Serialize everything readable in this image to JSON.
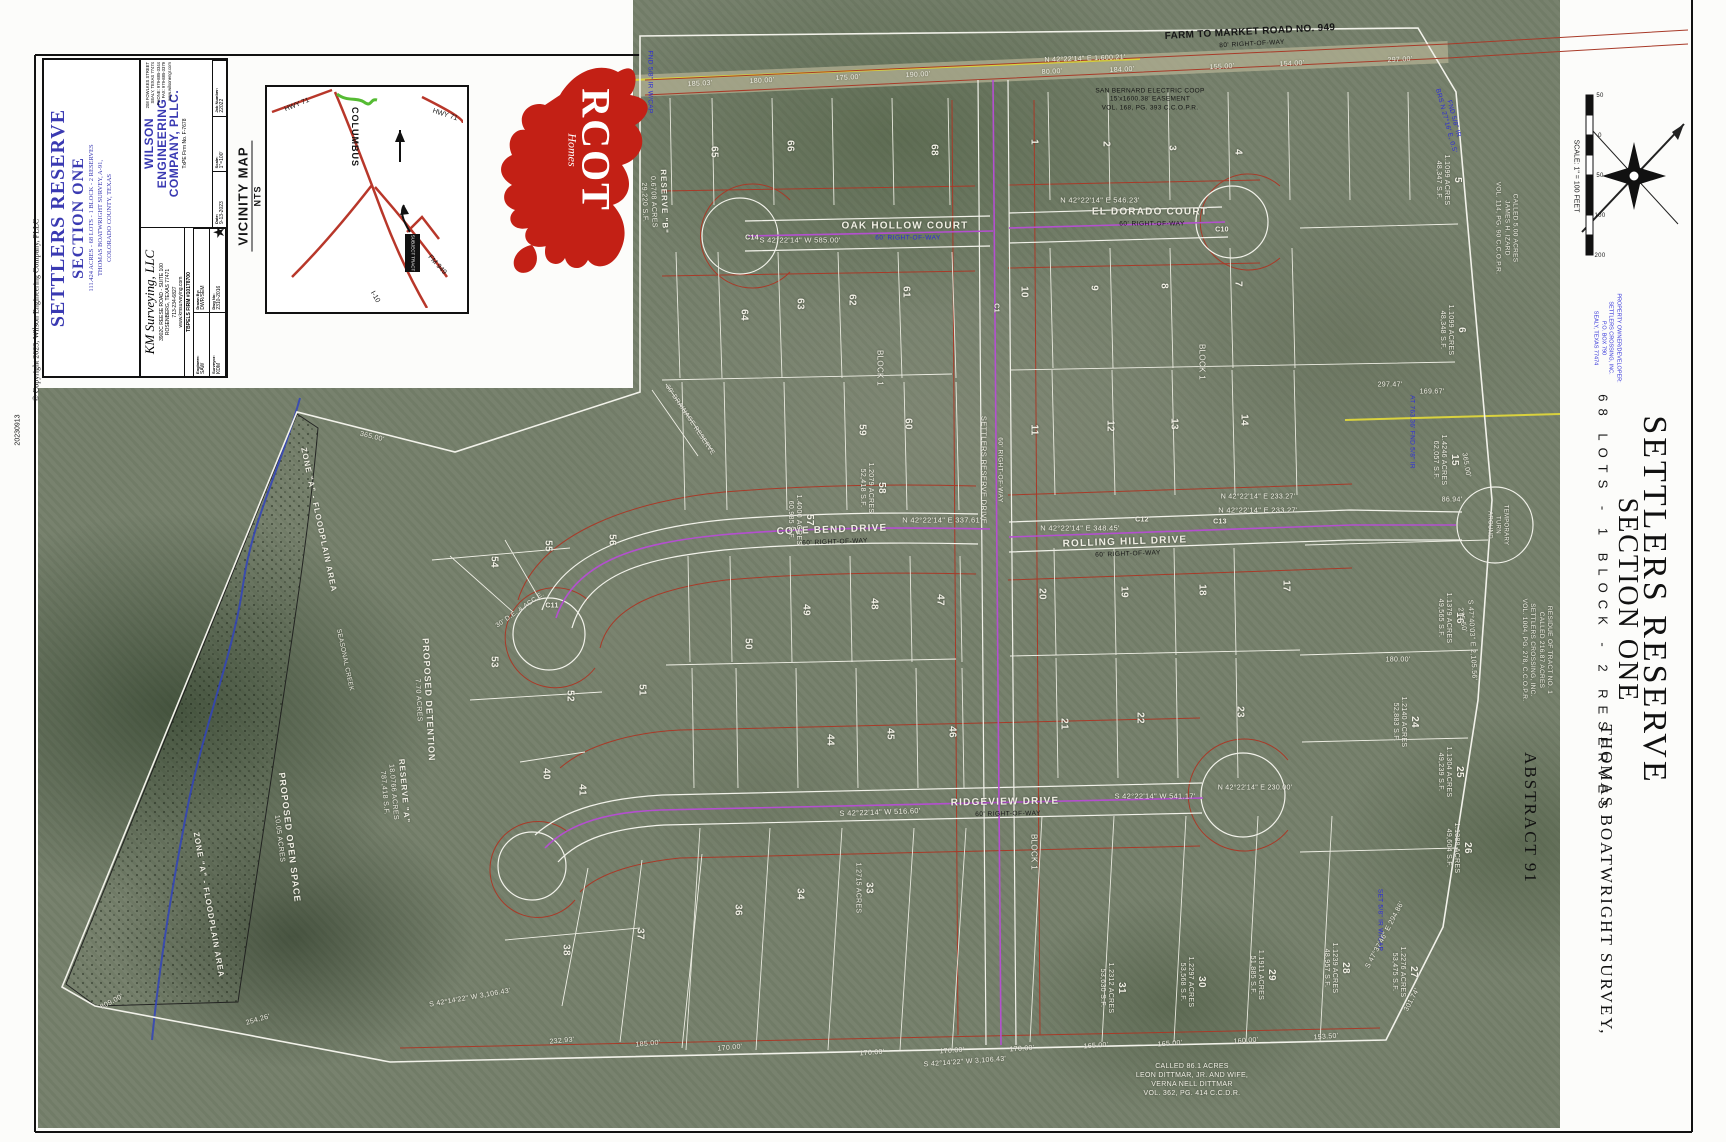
{
  "page": {
    "copyright": "© Copyright 2023, Wilson Engineering Company, PLLC",
    "stamp": "20230913"
  },
  "title_block": {
    "surveyor": {
      "name": "KM Surveying, LLC",
      "addr1": "3902C REESE ROAD - SUITE 100",
      "addr2": "ROSENBERG, TEXAS 77471",
      "phone": "713-234-6827",
      "web": "www.kmsurveying.com",
      "firm": "TBPELS FIRM #10178700"
    },
    "fields": {
      "f1l": "Engineer:",
      "f1v": "SAW",
      "f2l": "Drawn By:",
      "f2v": "DWR/SEM",
      "f3l": "Surveyor:",
      "f3v": "KDM",
      "f4l": "Dwg No:",
      "f4v": "2310-2016"
    },
    "title": {
      "line1": "SETTLERS RESERVE",
      "line2": "SECTION ONE",
      "sub1": "111.424 ACRES - 68 LOTS - 1 BLOCK - 2 RESERVES",
      "sub2": "THOMAS BOATWRIGHT SURVEY, A-91,",
      "sub3": "COLORADO COUNTY, TEXAS"
    },
    "engineer": {
      "name1": "WILSON",
      "name2": "ENGINEERING",
      "name3": "COMPANY, PLLC.",
      "firm": "TxPE Firm No. F-7678",
      "addr1": "208 FOWLKES STREET",
      "addr2": "SEALY, TEXAS 77474",
      "phone": "PHONE: 979-885-3344",
      "fax": "FAX: 979-885-3379",
      "web": "www.wilsonengr.com",
      "d1l": "Date:",
      "d1v": "9-13-2023",
      "d2l": "Scale:",
      "d2v": "1\"=100'",
      "d3l": "Job Number:",
      "d3v": "22022"
    }
  },
  "vicinity": {
    "label": "VICINITY MAP",
    "scale": "NTS",
    "town": "COLUMBUS",
    "hwy71a": "HWY 71",
    "hwy71b": "HWY 71",
    "fm949": "FM 949",
    "i10": "I-10",
    "site": "SUBJECT TRACT"
  },
  "logo": {
    "brand": "RCOT",
    "sub": "Homes"
  },
  "margin": {
    "title1": "SETTLERS RESERVE",
    "title2": "SECTION ONE",
    "subtitle": "68 LOTS - 1 BLOCK - 2 RESERVES",
    "survey": "THOMAS BOATWRIGHT SURVEY,",
    "abstract": "ABSTRACT 91",
    "scale_label": "SCALE: 1\" = 100 FEET",
    "owner": [
      "PROPERTY OWNER/DEVELOPER:",
      "SETTLERS CROSSING, INC.",
      "P.O. BOX 790",
      "SEALY, TEXAS 77474"
    ],
    "scale_ticks": [
      {
        "t": "50",
        "x": 1600,
        "y": 96
      },
      {
        "t": "0",
        "x": 1600,
        "y": 136
      },
      {
        "t": "50",
        "x": 1600,
        "y": 176
      },
      {
        "t": "100",
        "x": 1600,
        "y": 216
      },
      {
        "t": "200",
        "x": 1600,
        "y": 256
      }
    ]
  },
  "map": {
    "fm_road": {
      "name": "FARM TO MARKET ROAD NO. 949",
      "row": "80' RIGHT-OF-WAY",
      "bearing": "N 42°22'14\" E   1,600.21'"
    },
    "streets": {
      "oak_hollow": {
        "name": "OAK HOLLOW COURT",
        "row": "60' RIGHT-OF-WAY",
        "bearing": "S 42°22'14\" W   585.00'"
      },
      "el_dorado": {
        "name": "EL DORADO COURT",
        "row": "60' RIGHT-OF-WAY",
        "bearing": "N 42°22'14\" E   546.23'"
      },
      "cove_bend": {
        "name": "COVE BEND DRIVE",
        "row": "60' RIGHT-OF-WAY",
        "bearing": "N 42°22'14\" E   337.61'"
      },
      "rolling_hill": {
        "name": "ROLLING HILL DRIVE",
        "row": "60' RIGHT-OF-WAY",
        "bearing": "N 42°22'14\" E   348.45'",
        "bearing2": "N 42°22'14\" E   233.27'"
      },
      "ridgeview": {
        "name": "RIDGEVIEW DRIVE",
        "row": "60' RIGHT-OF-WAY",
        "bearing": "S 42°22'14\" W   516.60'",
        "bearing2": "S 42°22'14\" W   541.17'"
      },
      "settlers": {
        "name": "SETTLERS RESERVE DRIVE",
        "row": "60' RIGHT-OF-WAY"
      }
    },
    "notes": {
      "easement": [
        "SAN BERNARD ELECTRIC COOP",
        "15'x1600.38' EASEMENT",
        "VOL. 168, PG. 393 C.C.O.P.R."
      ],
      "izard": [
        "CALLED 5.00 ACRES",
        "JAMES H. IZARD",
        "VOL. 114, PG. 90 C.C.O.P.R."
      ],
      "residue": [
        "RESIDUE OF TRACT NO. 1",
        "CALLED 216.87 ACRES",
        "SETTLERS CROSSING, INC.",
        "VOL. 1004, PG. 278, C.C.O.P.R."
      ],
      "dittmar": [
        "CALLED 86.1 ACRES",
        "LEON DITTMAR, JR. AND WIFE,",
        "VERNA NELL DITTMAR",
        "VOL. 362, PG. 414 C.C.D.R."
      ]
    },
    "areas": {
      "zone_a": "ZONE \"A\" - FLOODPLAIN AREA",
      "creek": "SEASONAL CREEK",
      "open_space": [
        "PROPOSED OPEN SPACE",
        "10.05 ACRES"
      ],
      "reserve_a": [
        "RESERVE \"A\"",
        "18.0766 ACRES",
        "787,418 S.F."
      ],
      "detention": [
        "PROPOSED DETENTION",
        "7.70 ACRES"
      ],
      "reserve_b": [
        "RESERVE \"B\"",
        "0.6708 ACRES",
        "29,220 S.F."
      ],
      "drainage": "30' DRAINAGE RESERVE",
      "de_acce": "30' D.E. & ACC.E.",
      "turnaround": [
        "TEMPORARY",
        "TURN",
        "AROUND"
      ],
      "block": "BLOCK 1"
    },
    "monuments": {
      "m1": "FND 5/8\" IR W/CAP",
      "m2": "FND 5/8\" IR",
      "m2b": "BRS N 27°16' E, 0.5'",
      "m3": "AT 763.36'  FND 5/8\" IR",
      "m4": "SET 5/8\" IR W/CAP"
    },
    "lots": [
      {
        "n": "5",
        "ac": "1.1099 ACRES",
        "sf": "48,347 S.F.",
        "x": 1448,
        "y": 180,
        "r": 90
      },
      {
        "n": "6",
        "ac": "1.1099 ACRES",
        "sf": "48,348 S.F.",
        "x": 1452,
        "y": 330,
        "r": 90
      },
      {
        "n": "15",
        "ac": "1.4246 ACRES",
        "sf": "62,057 S.F.",
        "x": 1445,
        "y": 460,
        "r": 90
      },
      {
        "n": "16",
        "ac": "1.1379 ACRES",
        "sf": "49,565 S.F.",
        "x": 1450,
        "y": 618,
        "r": 90
      },
      {
        "n": "24",
        "ac": "1.2140 ACRES",
        "sf": "52,883 S.F.",
        "x": 1405,
        "y": 722,
        "r": 90
      },
      {
        "n": "25",
        "ac": "1.1304 ACRES",
        "sf": "49,239 S.F.",
        "x": 1450,
        "y": 772,
        "r": 90
      },
      {
        "n": "26",
        "ac": "1.1388 ACRES",
        "sf": "49,604 S.F.",
        "x": 1458,
        "y": 848,
        "r": 90
      },
      {
        "n": "27",
        "ac": "1.2276 ACRES",
        "sf": "53,475 S.F.",
        "x": 1404,
        "y": 972,
        "r": 90
      },
      {
        "n": "28",
        "ac": "1.1239 ACRES",
        "sf": "48,957 S.F.",
        "x": 1336,
        "y": 968,
        "r": 90
      },
      {
        "n": "29",
        "ac": "1.1911 ACRES",
        "sf": "51,885 S.F.",
        "x": 1262,
        "y": 975,
        "r": 90
      },
      {
        "n": "30",
        "ac": "1.2297 ACRES",
        "sf": "53,568 S.F.",
        "x": 1192,
        "y": 982,
        "r": 90
      },
      {
        "n": "31",
        "ac": "1.2312 ACRES",
        "sf": "53,630 S.F.",
        "x": 1112,
        "y": 988,
        "r": 90
      },
      {
        "n": "33",
        "ac": "1.2715 ACRES",
        "sf": "",
        "x": 864,
        "y": 888,
        "r": 90
      },
      {
        "n": "57",
        "ac": "1.4000 ACRES",
        "sf": "60,985 S.F.",
        "x": 800,
        "y": 520,
        "r": 90
      },
      {
        "n": "58",
        "ac": "1.2079 ACRES",
        "sf": "52,418 S.F.",
        "x": 872,
        "y": 488,
        "r": 90
      }
    ],
    "lot_numbers": [
      {
        "n": "65",
        "x": 714,
        "y": 152,
        "r": 90
      },
      {
        "n": "66",
        "x": 790,
        "y": 146,
        "r": 90
      },
      {
        "n": "68",
        "x": 934,
        "y": 150,
        "r": 90
      },
      {
        "n": "1",
        "x": 1034,
        "y": 142,
        "r": 90
      },
      {
        "n": "2",
        "x": 1106,
        "y": 144,
        "r": 90
      },
      {
        "n": "3",
        "x": 1172,
        "y": 148,
        "r": 90
      },
      {
        "n": "4",
        "x": 1238,
        "y": 152,
        "r": 90
      },
      {
        "n": "64",
        "x": 744,
        "y": 315,
        "r": 90
      },
      {
        "n": "63",
        "x": 800,
        "y": 304,
        "r": 90
      },
      {
        "n": "62",
        "x": 852,
        "y": 300,
        "r": 90
      },
      {
        "n": "61",
        "x": 906,
        "y": 292,
        "r": 90
      },
      {
        "n": "10",
        "x": 1024,
        "y": 292,
        "r": 90
      },
      {
        "n": "9",
        "x": 1094,
        "y": 288,
        "r": 90
      },
      {
        "n": "8",
        "x": 1164,
        "y": 286,
        "r": 90
      },
      {
        "n": "7",
        "x": 1238,
        "y": 284,
        "r": 90
      },
      {
        "n": "59",
        "x": 862,
        "y": 430,
        "r": 90
      },
      {
        "n": "60",
        "x": 908,
        "y": 424,
        "r": 90
      },
      {
        "n": "11",
        "x": 1034,
        "y": 430,
        "r": 90
      },
      {
        "n": "12",
        "x": 1110,
        "y": 426,
        "r": 90
      },
      {
        "n": "13",
        "x": 1174,
        "y": 424,
        "r": 90
      },
      {
        "n": "14",
        "x": 1244,
        "y": 420,
        "r": 90
      },
      {
        "n": "50",
        "x": 748,
        "y": 644,
        "r": 90
      },
      {
        "n": "49",
        "x": 806,
        "y": 610,
        "r": 90
      },
      {
        "n": "48",
        "x": 874,
        "y": 604,
        "r": 90
      },
      {
        "n": "47",
        "x": 940,
        "y": 600,
        "r": 90
      },
      {
        "n": "20",
        "x": 1042,
        "y": 594,
        "r": 90
      },
      {
        "n": "19",
        "x": 1124,
        "y": 592,
        "r": 90
      },
      {
        "n": "18",
        "x": 1202,
        "y": 590,
        "r": 90
      },
      {
        "n": "17",
        "x": 1286,
        "y": 586,
        "r": 90
      },
      {
        "n": "44",
        "x": 830,
        "y": 740,
        "r": 90
      },
      {
        "n": "45",
        "x": 890,
        "y": 734,
        "r": 90
      },
      {
        "n": "46",
        "x": 952,
        "y": 732,
        "r": 90
      },
      {
        "n": "21",
        "x": 1064,
        "y": 724,
        "r": 90
      },
      {
        "n": "22",
        "x": 1140,
        "y": 718,
        "r": 90
      },
      {
        "n": "23",
        "x": 1240,
        "y": 712,
        "r": 90
      },
      {
        "n": "56",
        "x": 612,
        "y": 540,
        "r": 90
      },
      {
        "n": "55",
        "x": 548,
        "y": 546,
        "r": 90
      },
      {
        "n": "54",
        "x": 494,
        "y": 562,
        "r": 90
      },
      {
        "n": "53",
        "x": 494,
        "y": 662,
        "r": 90
      },
      {
        "n": "52",
        "x": 570,
        "y": 696,
        "r": 90
      },
      {
        "n": "51",
        "x": 642,
        "y": 690,
        "r": 90
      },
      {
        "n": "40",
        "x": 546,
        "y": 774,
        "r": 90
      },
      {
        "n": "41",
        "x": 582,
        "y": 790,
        "r": 90
      },
      {
        "n": "34",
        "x": 800,
        "y": 894,
        "r": 90
      },
      {
        "n": "36",
        "x": 738,
        "y": 910,
        "r": 90
      },
      {
        "n": "37",
        "x": 640,
        "y": 934,
        "r": 90
      },
      {
        "n": "38",
        "x": 566,
        "y": 950,
        "r": 90
      }
    ],
    "dims": [
      {
        "t": "185.03'",
        "x": 700,
        "y": 84,
        "r": -3
      },
      {
        "t": "180.00'",
        "x": 762,
        "y": 81,
        "r": -3
      },
      {
        "t": "175.00'",
        "x": 848,
        "y": 78,
        "r": -3
      },
      {
        "t": "190.00'",
        "x": 918,
        "y": 75,
        "r": -3
      },
      {
        "t": "80.00'",
        "x": 1052,
        "y": 72,
        "r": -3
      },
      {
        "t": "184.00'",
        "x": 1122,
        "y": 70,
        "r": -3
      },
      {
        "t": "155.00'",
        "x": 1222,
        "y": 67,
        "r": -3
      },
      {
        "t": "154.00'",
        "x": 1292,
        "y": 64,
        "r": -3
      },
      {
        "t": "297.00'",
        "x": 1400,
        "y": 60,
        "r": -3
      },
      {
        "t": "232.93'",
        "x": 562,
        "y": 1041,
        "r": -5
      },
      {
        "t": "185.00'",
        "x": 648,
        "y": 1044,
        "r": -5
      },
      {
        "t": "170.00'",
        "x": 730,
        "y": 1048,
        "r": -5
      },
      {
        "t": "170.00'",
        "x": 872,
        "y": 1053,
        "r": -4
      },
      {
        "t": "170.00'",
        "x": 952,
        "y": 1051,
        "r": -4
      },
      {
        "t": "170.00'",
        "x": 1022,
        "y": 1049,
        "r": -4
      },
      {
        "t": "165.00'",
        "x": 1096,
        "y": 1046,
        "r": -4
      },
      {
        "t": "165.00'",
        "x": 1170,
        "y": 1044,
        "r": -4
      },
      {
        "t": "160.00'",
        "x": 1246,
        "y": 1041,
        "r": -4
      },
      {
        "t": "153.50'",
        "x": 1326,
        "y": 1037,
        "r": -4
      },
      {
        "t": "N 42°22'14\" E   1,600.21'",
        "x": 1085,
        "y": 59,
        "r": -2
      },
      {
        "t": "N 42°22'14\" E   233.27'",
        "x": 1258,
        "y": 497,
        "r": 0
      },
      {
        "t": "86.94'",
        "x": 1452,
        "y": 500,
        "r": 0
      },
      {
        "t": "N 42°22'14\" E   230.00'",
        "x": 1255,
        "y": 788,
        "r": 0
      },
      {
        "t": "S 47°40'03\" E   2,105.56'",
        "x": 1472,
        "y": 640,
        "r": 87
      },
      {
        "t": "S 47°37'46\" E   294.86'",
        "x": 1385,
        "y": 935,
        "r": -62
      },
      {
        "t": "S 42°14'22\" W   3,106.43'",
        "x": 470,
        "y": 998,
        "r": -10
      },
      {
        "t": "S 42°14'22\" W   3,106.43'",
        "x": 965,
        "y": 1062,
        "r": -4
      },
      {
        "t": "809.00'",
        "x": 112,
        "y": 1002,
        "r": -28
      },
      {
        "t": "254.26'",
        "x": 258,
        "y": 1020,
        "r": -16
      },
      {
        "t": "365.00'",
        "x": 372,
        "y": 437,
        "r": 14
      },
      {
        "t": "301.74'",
        "x": 1412,
        "y": 1000,
        "r": -62
      },
      {
        "t": "297.47'",
        "x": 1390,
        "y": 385,
        "r": 0
      },
      {
        "t": "169.67'",
        "x": 1432,
        "y": 392,
        "r": 0
      },
      {
        "t": "180.00'",
        "x": 1398,
        "y": 660,
        "r": 0
      },
      {
        "t": "365.00'",
        "x": 1466,
        "y": 465,
        "r": 80
      },
      {
        "t": "275.50'",
        "x": 1462,
        "y": 620,
        "r": 80
      }
    ],
    "curves": [
      {
        "t": "C14",
        "x": 752,
        "y": 238,
        "r": 0
      },
      {
        "t": "C10",
        "x": 1222,
        "y": 230,
        "r": 0
      },
      {
        "t": "C1",
        "x": 996,
        "y": 308,
        "r": 90
      },
      {
        "t": "C12",
        "x": 1142,
        "y": 520,
        "r": 0
      },
      {
        "t": "C13",
        "x": 1220,
        "y": 522,
        "r": 0
      },
      {
        "t": "C11",
        "x": 552,
        "y": 606,
        "r": 0
      }
    ]
  }
}
